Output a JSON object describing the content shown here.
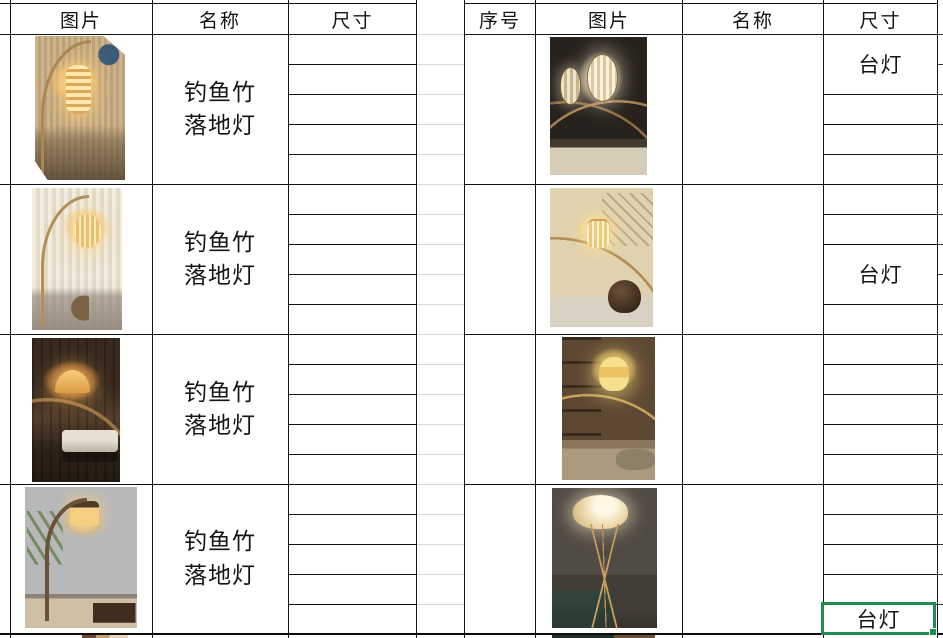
{
  "sheet": {
    "kind": "spreadsheet-product-catalog",
    "colors": {
      "grid_line": "#141414",
      "light_grid_line": "#d9d9d9",
      "selection_green": "#1f8c52",
      "background": "#ffffff"
    }
  },
  "left_table": {
    "headers": {
      "image": "图片",
      "name": "名称",
      "size": "尺寸"
    },
    "rows": [
      {
        "name": "钓鱼竹落地灯",
        "photo_desc": "竹制弧形落地灯，米色格栅墙前层叠竹环灯罩，右上圆窗",
        "sizes": [
          "",
          "",
          "",
          "",
          ""
        ]
      },
      {
        "name": "钓鱼竹落地灯",
        "photo_desc": "竹制弧形落地灯，浅色条纹窗帘旁圆形灯笼罩与小边几",
        "sizes": [
          "",
          "",
          "",
          "",
          ""
        ]
      },
      {
        "name": "钓鱼竹落地灯",
        "photo_desc": "暗色房间中的竹编半圆罩弧形落地灯与白色长凳",
        "sizes": [
          "",
          "",
          "",
          "",
          ""
        ]
      },
      {
        "name": "钓鱼竹落地灯",
        "photo_desc": "灰墙前仿古木柱灯笼落地灯，左侧棕榈叶，右侧茶桌",
        "sizes": [
          "",
          "",
          "",
          "",
          ""
        ]
      }
    ]
  },
  "right_table": {
    "headers": {
      "index": "序号",
      "image": "图片",
      "name": "名称",
      "size": "尺寸"
    },
    "rows": [
      {
        "index": "",
        "name": "",
        "size_label": "台灯",
        "photo_desc": "暗色房间内竹竿吊挂的椭圆编织灯笼成排发光"
      },
      {
        "index": "",
        "name": "",
        "size_label": "台灯",
        "photo_desc": "米色墙角竹弧形灯、圆柱条纹灯罩与深色陶罐"
      },
      {
        "index": "",
        "name": "",
        "size_label": "",
        "photo_desc": "茶壶展示架旁竹弧形灯与塔形竹编灯罩"
      },
      {
        "index": "",
        "name": "",
        "size_label": "台灯",
        "photo_desc": "暗色房间内三脚竹编圆顶落地灯"
      }
    ]
  },
  "selection": {
    "cell_value": "台灯"
  }
}
